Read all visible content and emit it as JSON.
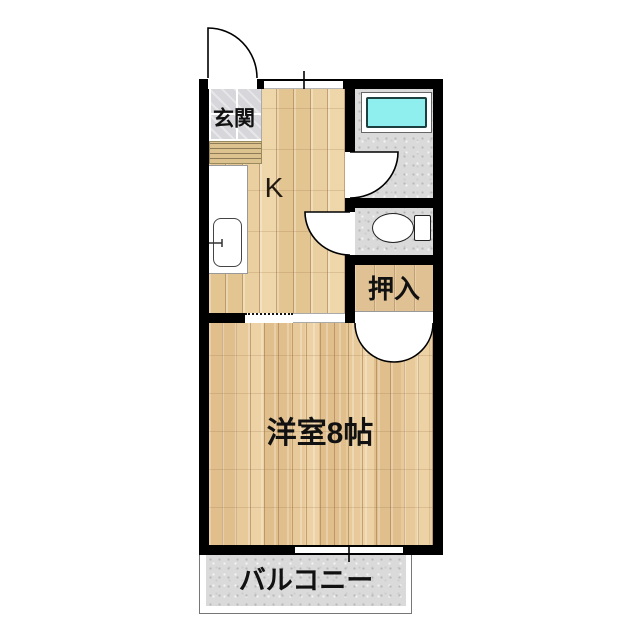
{
  "plan": {
    "type": "japanese-apartment-floorplan",
    "labels": {
      "entrance": "玄関",
      "kitchen": "K",
      "closet": "押入",
      "main_room": "洋室8帖",
      "balcony": "バルコニー"
    },
    "colors": {
      "wall": "#000000",
      "kitchen_wood": "#ead0a0",
      "room_wood": "#e8ca9a",
      "closet_wood": "#dfc193",
      "bathtub": "#8feeee",
      "wet_area_floor": "#dadada",
      "entrance_tile": "#d7d7db"
    }
  }
}
